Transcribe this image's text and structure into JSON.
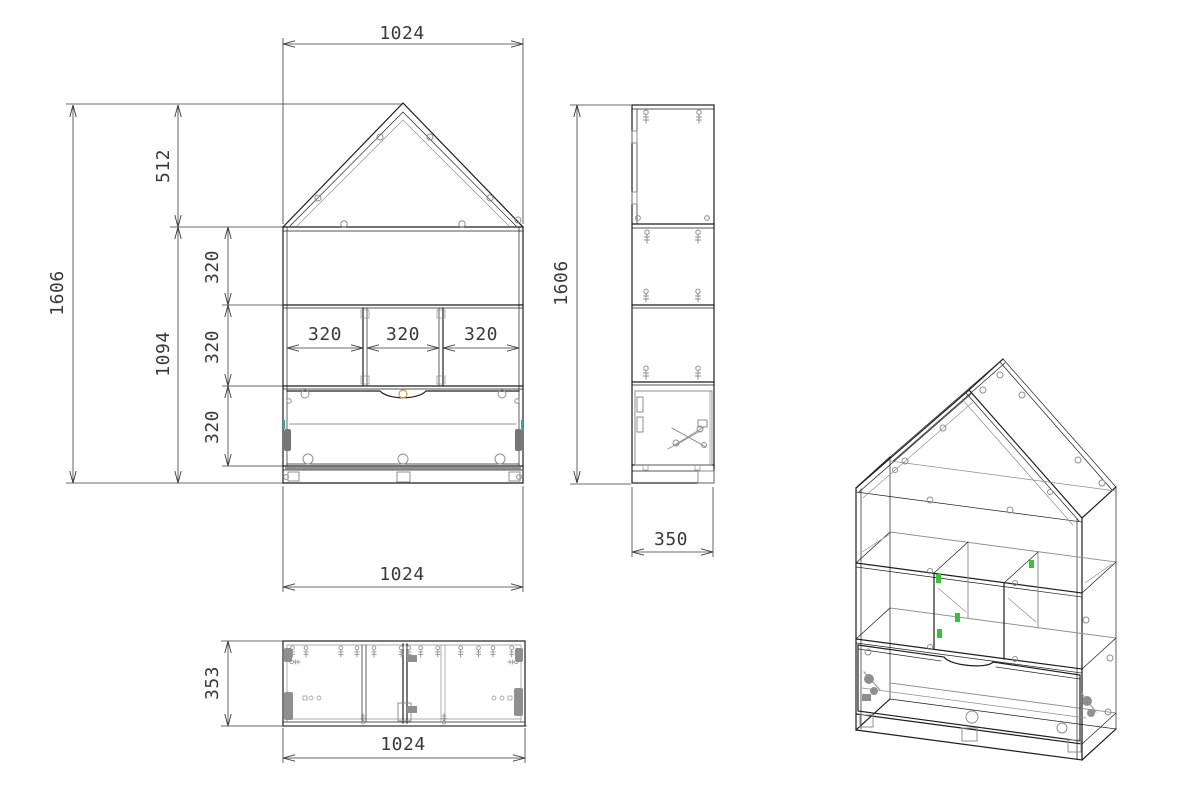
{
  "drawing": {
    "colors": {
      "line": "#1e1e1e",
      "dim": "#3a3a3a",
      "hardware": "#8f8f8f",
      "orange": "#e09a3c",
      "teal": "#3aa6a0",
      "green": "#35c435"
    },
    "front_view": {
      "width_top": "1024",
      "roof_height": "512",
      "total_height": "1606",
      "body_height": "1094",
      "row_heights": [
        "320",
        "320",
        "320"
      ],
      "compartment_widths": [
        "320",
        "320",
        "320"
      ],
      "width_bottom": "1024"
    },
    "side_view": {
      "height": "1606",
      "depth": "350"
    },
    "top_view": {
      "depth": "353",
      "width": "1024"
    }
  }
}
